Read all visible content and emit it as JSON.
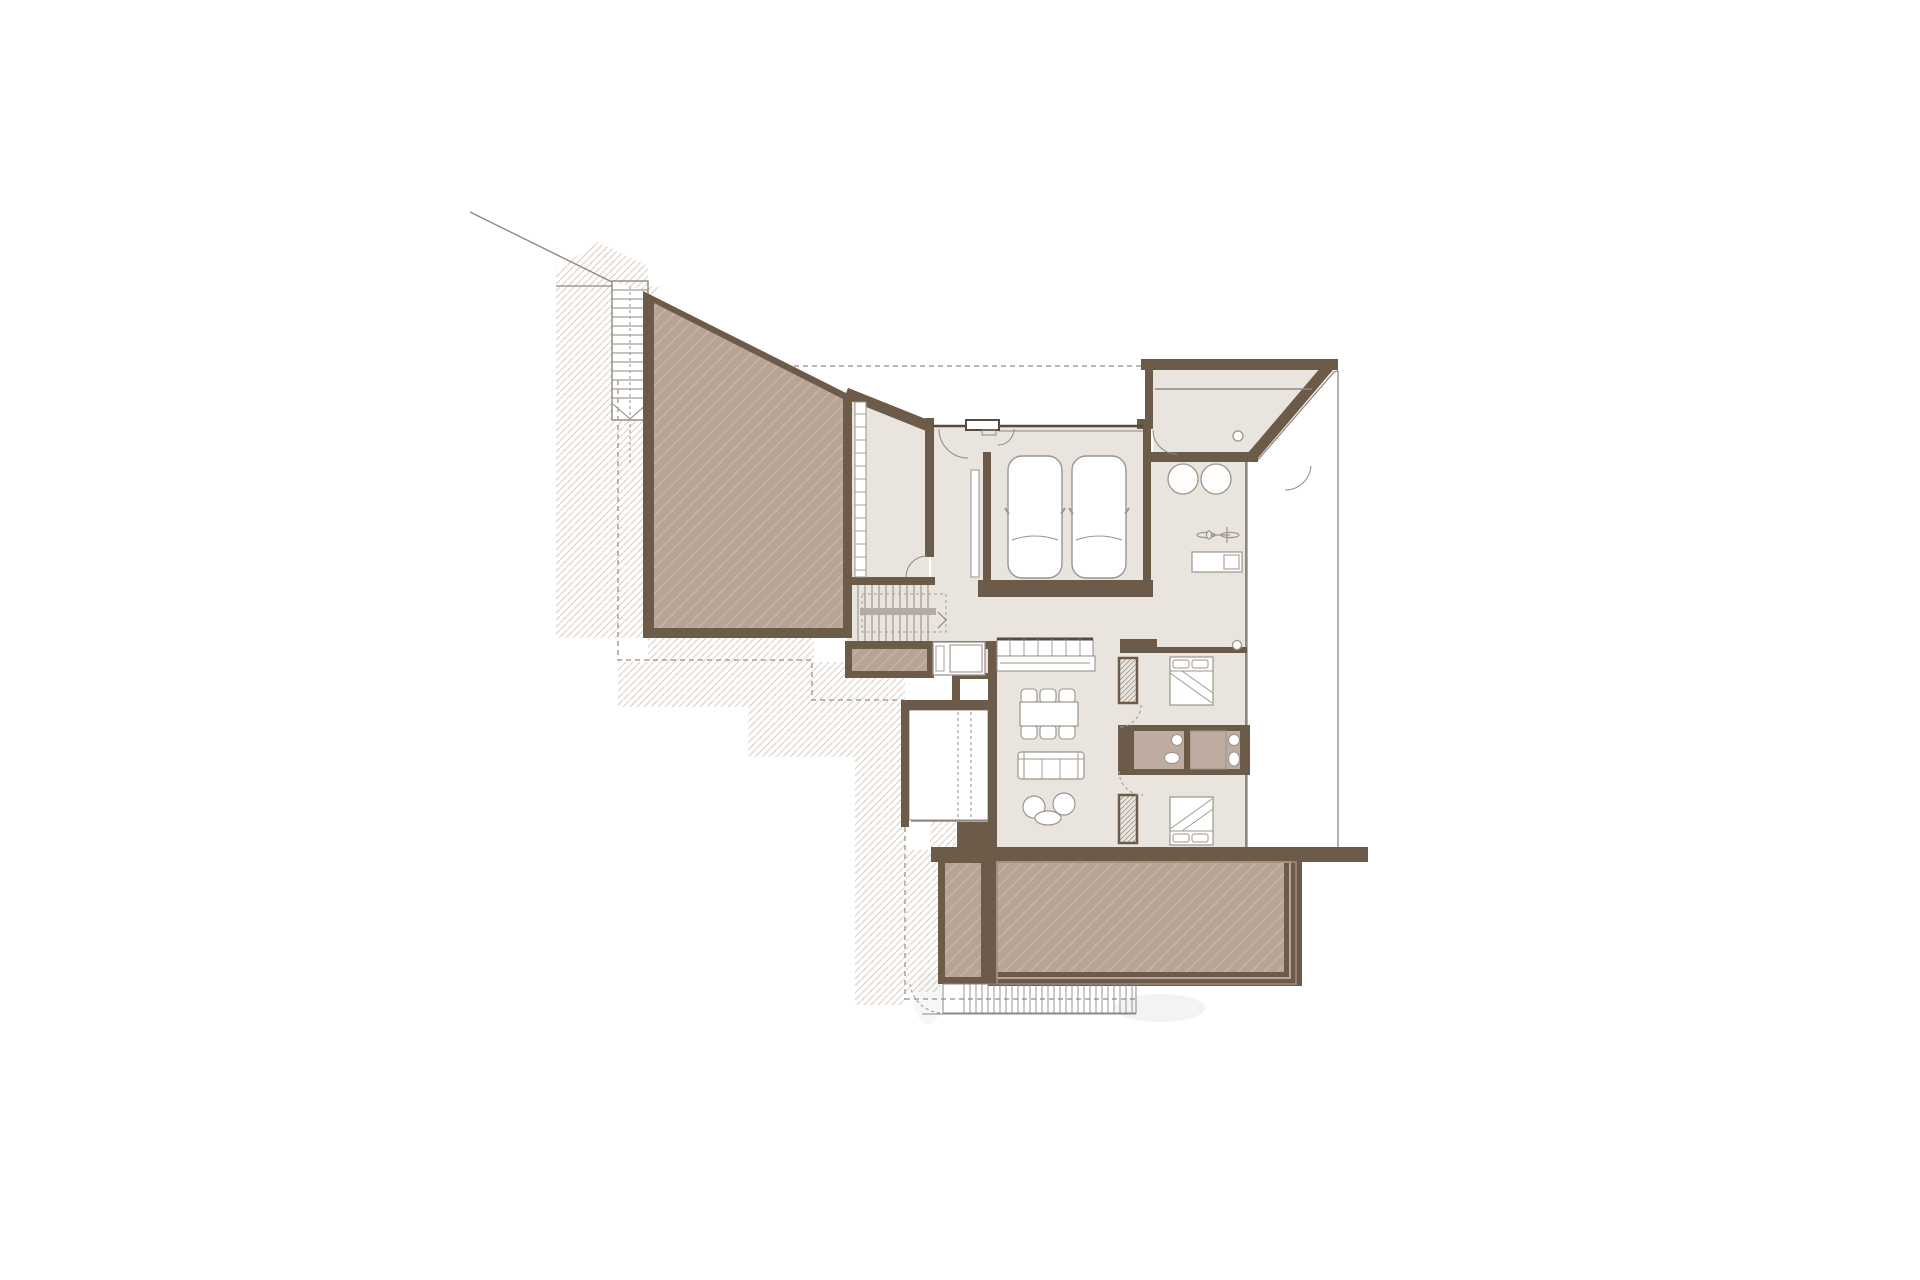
{
  "document": {
    "type": "architectural-floor-plan",
    "description": "Residential floor plan, entry level with garage, roof terrace and lower garden terrace",
    "visible_text": []
  },
  "colors": {
    "white": "#ffffff",
    "wall": "#6d5b49",
    "wall_dark": "#57493c",
    "floor": "#e9e4de",
    "roof_base": "#b7a497",
    "roof_line": "#c6b6a9",
    "terrain_line": "#ddd2c8",
    "deck_base": "#f0ece6",
    "deck_line": "#d9d1c8",
    "patio_base": "#f3ece5",
    "patio_line": "#ded3ca",
    "bath_floor": "#bdac9f",
    "line_thin": "#8f8880",
    "furn_stroke": "#9b958d",
    "dash": "#a8a199",
    "shadow": "#8a8a88"
  },
  "elements": {
    "terrain": "hatched-ground",
    "roof_terrace": "hatched-roof-terrace",
    "external_stair": "outdoor-staircase",
    "corridor": "corridor-with-shelves",
    "stair": "internal-staircase",
    "fireplace": "fireplace-cabinet",
    "entry": "entry-double-door-with-threshold",
    "garage": "garage-two-cars",
    "vestibule": "entry-vestibule-diagonal-wall",
    "utility": "utility-room-washer-dryer-bicycle-workbench",
    "kitchen": "kitchen-counter-and-island",
    "dining": "dining-table-six-chairs",
    "living": "sofa-and-coffee-tables",
    "bedroom1": "bedroom-north-bed",
    "bedroom2": "bedroom-south-bed",
    "bathrooms": "two-bathrooms-sink-toilet-shower",
    "wardrobes": "built-in-wardrobes",
    "deck": "east-wood-deck",
    "patio": "west-patio-deck",
    "lower_terrace": "lower-garden-terrace",
    "planters": "planter-strips",
    "grate": "grate-steps-strip"
  }
}
